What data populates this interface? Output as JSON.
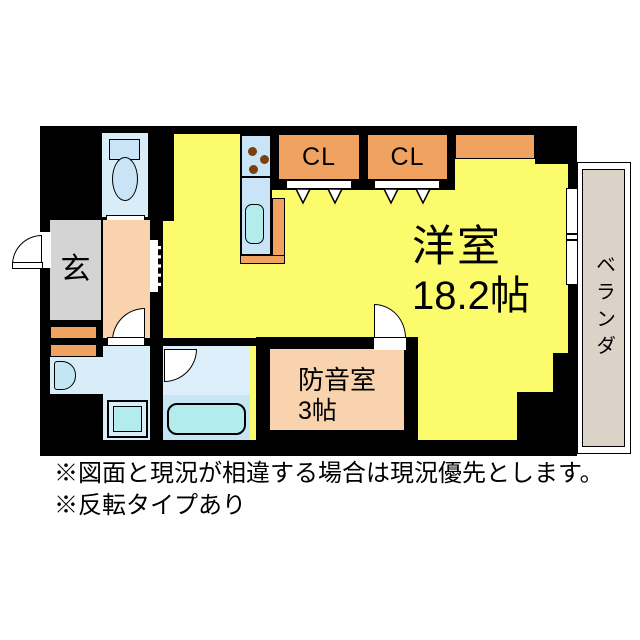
{
  "floorplan": {
    "rooms": {
      "main": {
        "name": "洋室",
        "size": "18.2帖"
      },
      "soundproof": {
        "name": "防音室",
        "size": "3帖"
      },
      "genkan": {
        "label": "玄"
      },
      "closet1": {
        "label": "CL"
      },
      "closet2": {
        "label": "CL"
      },
      "veranda": {
        "label": "ベランダ"
      }
    },
    "fixtures": [
      "toilet",
      "kitchen-stove",
      "kitchen-sink",
      "washbasin",
      "washing-machine",
      "bathtub"
    ],
    "colors": {
      "wall": "#000000",
      "room_yellow": "#FBFB6B",
      "closet_orange": "#F0A361",
      "hall_peach": "#F8D3AE",
      "genkan_gray": "#D4D4D4",
      "water_blue": "#D9EDF9",
      "counter_blue": "#C9E4F6",
      "fixture_cyan": "#B2ECEC",
      "veranda_beige": "#DCD3C8"
    }
  },
  "notes": {
    "line1": "※図面と現況が相違する場合は現況優先とします。",
    "line2": "※反転タイプあり"
  }
}
